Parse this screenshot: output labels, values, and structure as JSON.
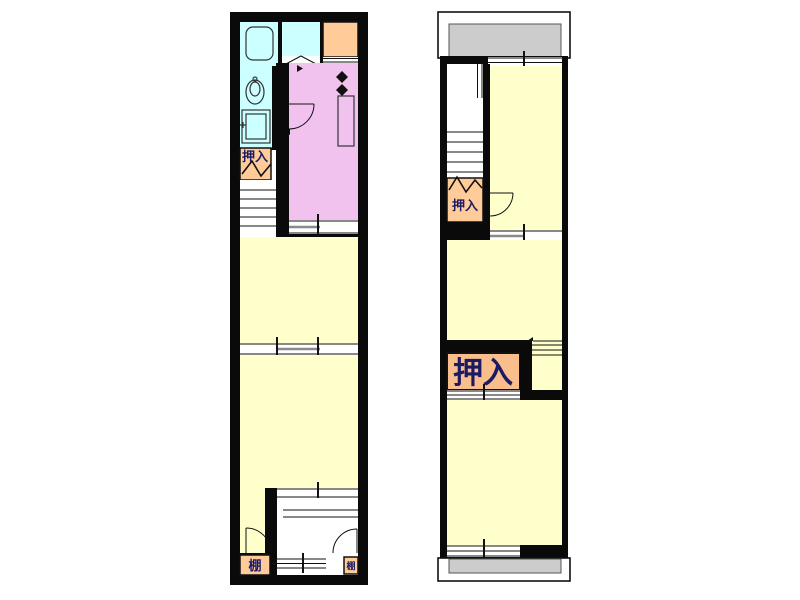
{
  "diagram": {
    "type": "floor-plan",
    "description_visible_text_only": true
  },
  "labels": {
    "f1_closet": "押入",
    "f1_shelf_left": "棚",
    "f1_shelf_right": "棚",
    "f2_closet_upper": "押入",
    "f2_closet_large": "押入"
  },
  "colors": {
    "wall": "#0A0A0A",
    "room_yellow": "#FFFFCC",
    "wet_area_cyan": "#CCFFFF",
    "kitchen_pink": "#F2C2EF",
    "closet_orange": "#FFCC99",
    "closet_orange_large": "#F9BE8C",
    "balcony_gray": "#CCCCCC",
    "label_navy": "#1A1A66",
    "background": "#FFFFFF"
  }
}
